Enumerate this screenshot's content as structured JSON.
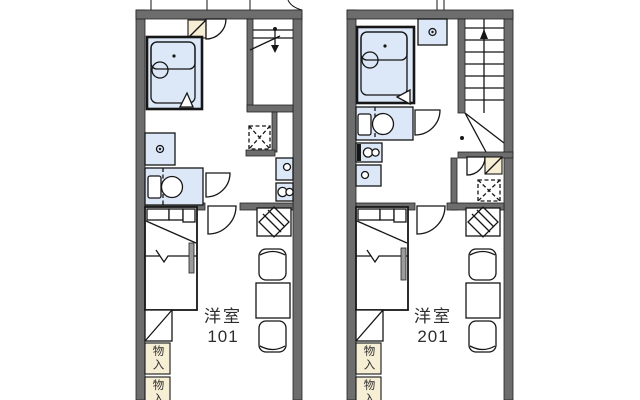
{
  "plan": {
    "type": "apartment-floor-plan",
    "colors": {
      "wall": "#6d6d6d",
      "fixture_fill": "#dce8f7",
      "storage_fill": "#f7efd5",
      "line": "#161616",
      "background": "#ffffff"
    },
    "units": [
      {
        "name": "unit-101",
        "room_label": "洋室",
        "room_number": "101",
        "storage": [
          {
            "label": "物入"
          },
          {
            "label": "物入"
          }
        ],
        "fixtures": [
          "bathtub",
          "washing-machine",
          "toilet",
          "kitchen-sink",
          "gas-stove",
          "refrigerator-space",
          "staircase-under",
          "entrance-step",
          "doors",
          "closet",
          "dining-table",
          "chairs",
          "tv-stand",
          "storage-boxes"
        ]
      },
      {
        "name": "unit-201",
        "room_label": "洋室",
        "room_number": "201",
        "storage": [
          {
            "label": "物入"
          },
          {
            "label": "物入"
          }
        ],
        "fixtures": [
          "bathtub",
          "washing-machine",
          "toilet",
          "kitchen-sink",
          "gas-stove",
          "refrigerator-space",
          "staircase",
          "entrance-step",
          "doors",
          "closet",
          "dining-table",
          "chairs",
          "tv-stand",
          "storage-boxes"
        ]
      }
    ]
  }
}
